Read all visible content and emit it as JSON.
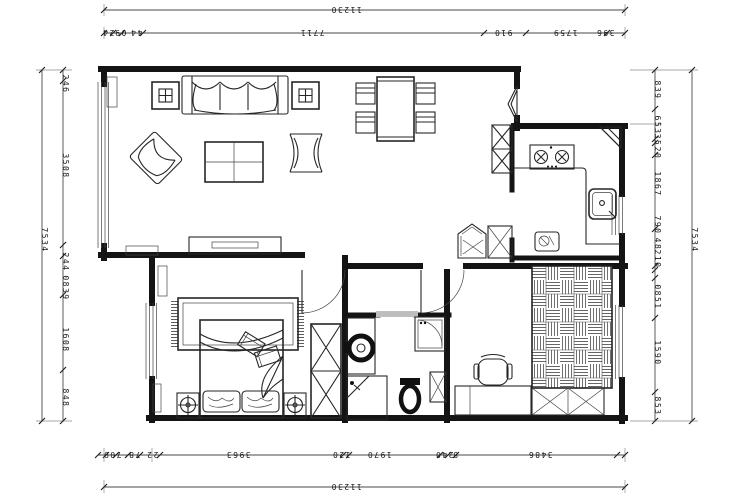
{
  "page": {
    "title": "Apartment floor plan (CAD export)",
    "background": "#ffffff"
  },
  "colors": {
    "line": "#262626",
    "wall": "#141414",
    "sliding_door": "#bdbdbd",
    "hatch": "#444444"
  },
  "dimensions": {
    "top": {
      "overall": "11230",
      "segments": [
        "24",
        "09",
        "44",
        "7711",
        "910",
        "1759",
        "396"
      ]
    },
    "bottom": {
      "overall": "11230",
      "segments": [
        "709",
        "78",
        "22",
        "3963",
        "120",
        "1970",
        "240",
        "8",
        "3486"
      ]
    },
    "left": {
      "overall": "7534",
      "segments": [
        "246",
        "3508",
        "244",
        "0839",
        "1608",
        "848"
      ]
    },
    "right": {
      "overall": "7534",
      "segments": [
        "839",
        "653",
        "35",
        "20",
        "1867",
        "790",
        "48",
        "210",
        "0851",
        "1590",
        "853"
      ]
    }
  },
  "elements": {
    "living": [
      "sofa",
      "side-table",
      "armchair",
      "coffee-table",
      "lounge-chair",
      "tv-cabinet",
      "radiator"
    ],
    "dining": [
      "dining-table",
      "dining-chairs",
      "tall-cabinet"
    ],
    "kitchen": [
      "counter",
      "stove",
      "sink",
      "fridge",
      "small-appliance"
    ],
    "bathroom": [
      "vanity-basin",
      "washing-machine",
      "toilet",
      "shower-tiles",
      "cabinet"
    ],
    "bedroom": [
      "bed",
      "pillows",
      "cushions",
      "rug",
      "nightstand-lamps",
      "wardrobe",
      "radiator"
    ],
    "study": [
      "desk",
      "office-chair",
      "tatami-mat",
      "storage-bench",
      "radiator"
    ]
  }
}
